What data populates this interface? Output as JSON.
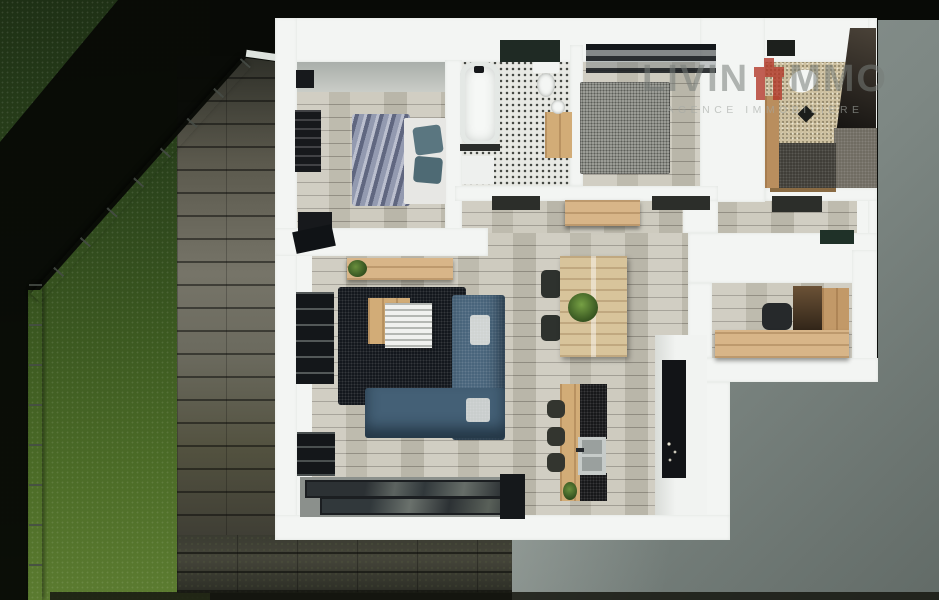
{
  "watermark": {
    "brand_left": "LIVIN",
    "brand_right": "MMO",
    "emblem_icon": "red-arch-monument-icon",
    "tagline": "AGENCE IMMOBILIERE"
  },
  "palette": {
    "brand_red": "#b23527",
    "wall_white": "#f3f5f3",
    "floor_wood": "#c8c5b8",
    "deck_wood": "#6b695c",
    "grass_green": "#4c6c27",
    "backdrop_gray": "#8d9694",
    "shadow_black": "#0a0c08",
    "sofa_navy": "#10141a",
    "sofa_blue": "#47637a",
    "oak_accent": "#d2ac77"
  }
}
